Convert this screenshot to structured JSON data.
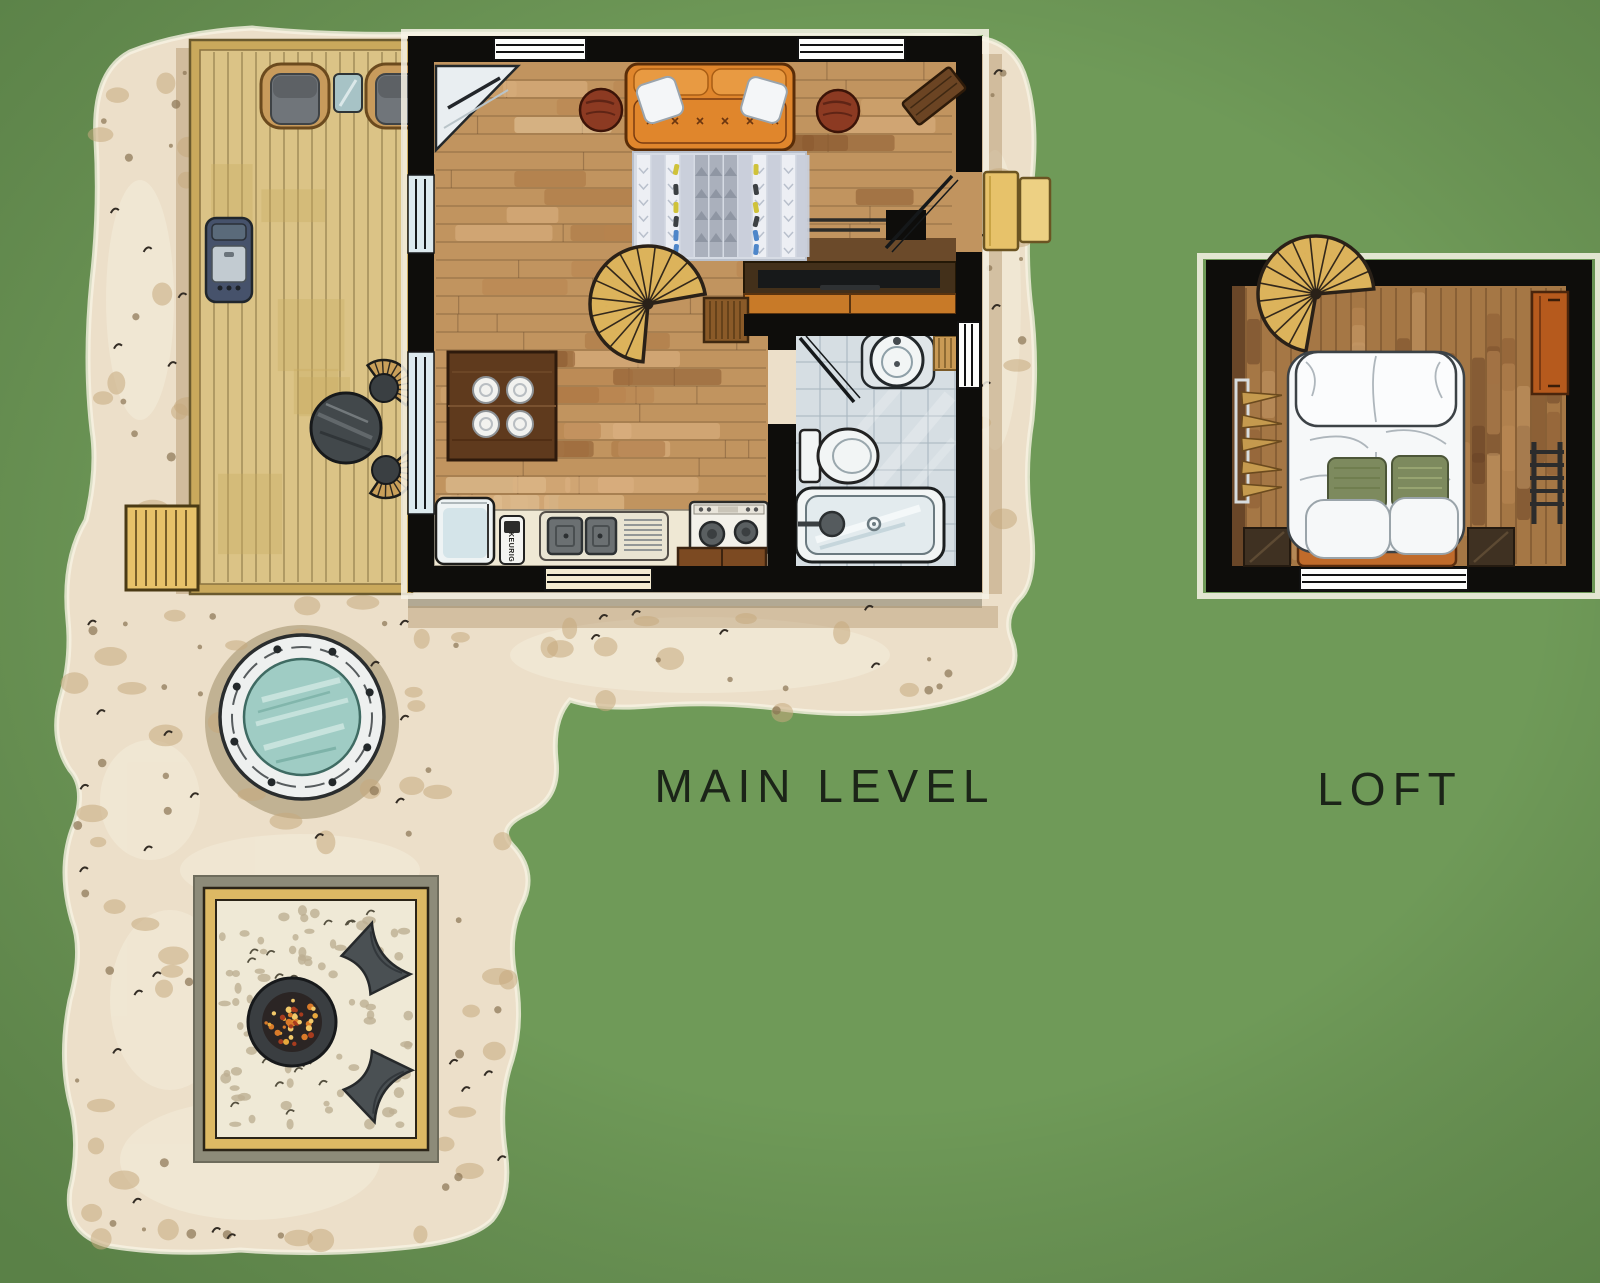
{
  "labels": {
    "main_level": "MAIN LEVEL",
    "loft": "LOFT",
    "coffee_maker": "KEURIG"
  },
  "colors": {
    "green_bg": "#6f9a58",
    "sand": "#ecdfc9",
    "sand_patch": "#c6a97d",
    "wall": "#0e0d0b",
    "deck": "#dbc386",
    "deck_edge": "#caa95c",
    "floor": "#c1945f",
    "loft_floor": "#a57745",
    "tile": "#d6dee3",
    "stair": "#dcb35b",
    "sofa": "#e0862c",
    "sofa_cushion": "#e89a42",
    "rug": "#d6dbe4",
    "water": "#9fccc4",
    "fixture_white": "#f2f5f5",
    "counter": "#efe8d4",
    "console": "#43301a",
    "wardrobe": "#c87a28",
    "table_wood": "#5f3a1d",
    "side_table": "#8c3a22",
    "bench": "#6b4423",
    "steps": "#e7c26a",
    "hot_tub_rim": "#eef0ef",
    "patio_frame": "#ddb964",
    "gravel": "#efe9d6",
    "stone": "#8d8b79",
    "fire_pit": "#3a3e41",
    "ember": "#d97b2a",
    "chair_dark": "#4a5053",
    "cushion_gray": "#70757a",
    "bed_white": "#f6f8f9",
    "pillow_green": "#7d8a5e",
    "bed_frame": "#c06b2b",
    "dresser": "#b65a1d",
    "nightstand": "#3f3122",
    "label": "#1b2418"
  }
}
